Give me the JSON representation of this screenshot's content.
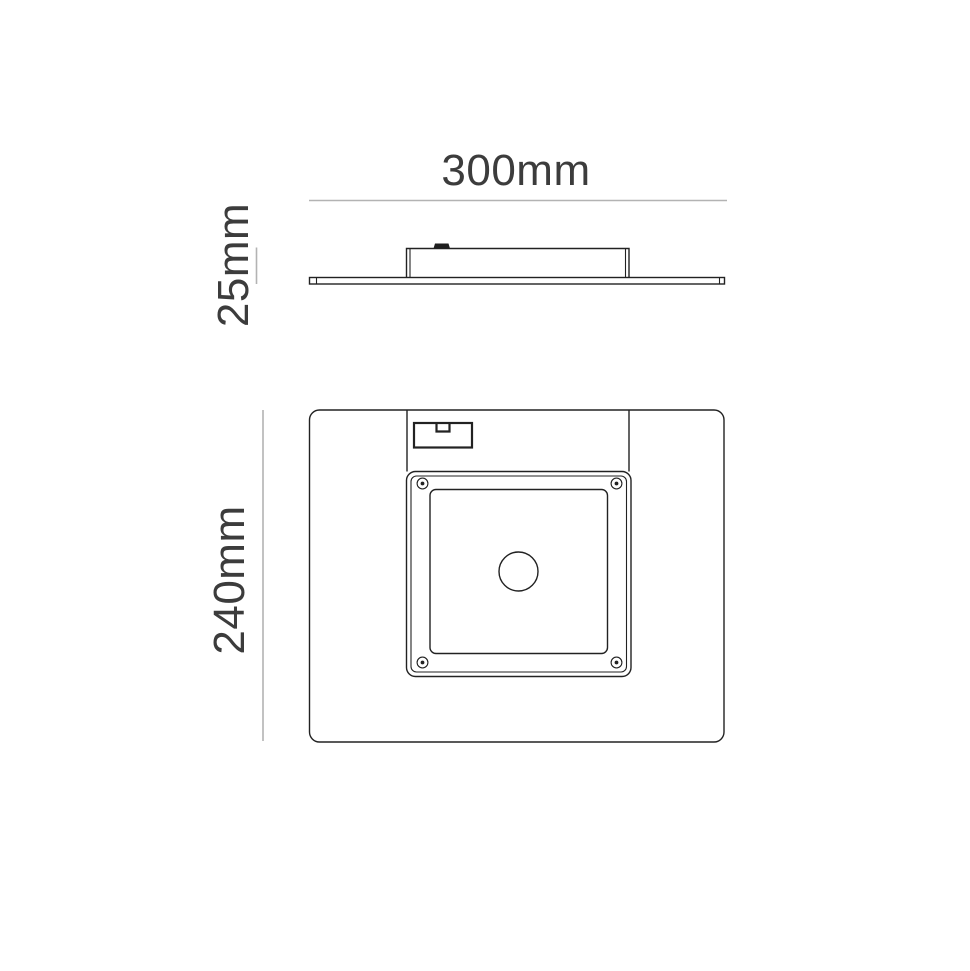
{
  "colors": {
    "page_background": "#ffffff",
    "outline": "#222222",
    "dimension_line": "#b3b3b3",
    "label_text": "#3c3c3c",
    "tab_fill": "#1e1e1e"
  },
  "side_view": {
    "width_label": "300mm",
    "height_label": "25mm"
  },
  "back_view": {
    "height_label": "240mm"
  }
}
